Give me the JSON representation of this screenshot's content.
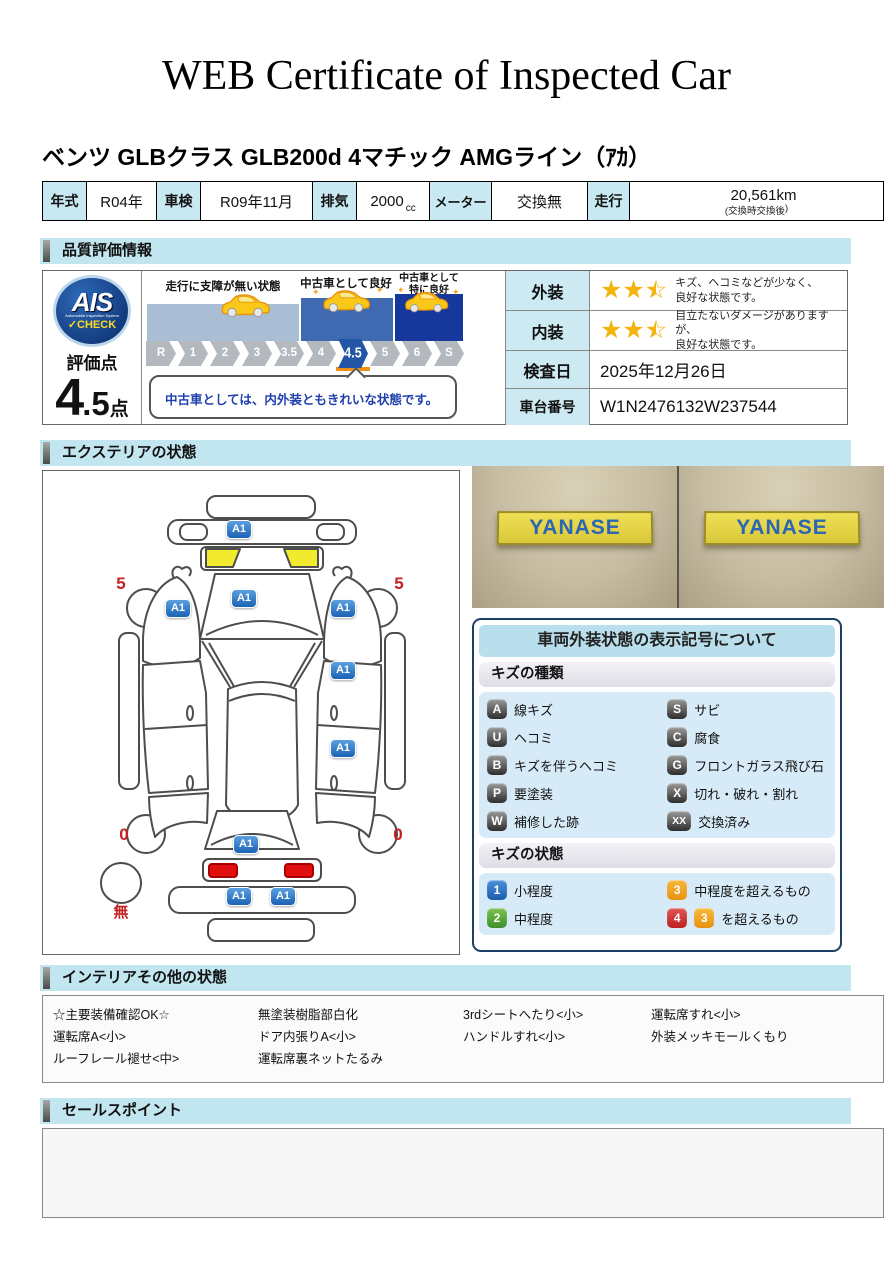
{
  "header": {
    "title": "WEB Certificate of Inspected Car",
    "vehicle": "ベンツ GLBクラス GLB200d 4マチック AMGライン（ｱｶ）"
  },
  "spec": {
    "year_label": "年式",
    "year": "R04年",
    "shaken_label": "車検",
    "shaken": "R09年11月",
    "haiki_label": "排気",
    "haiki": "2000",
    "haiki_unit": "cc",
    "meter_label": "メーター",
    "meter": "交換無",
    "soko_label": "走行",
    "mileage": "20,561km",
    "note_left": "(交換時",
    "note_mid": "交換後",
    "note_right": ")"
  },
  "sections": {
    "quality": "品質評価情報",
    "exterior": "エクステリアの状態",
    "interior": "インテリアその他の状態",
    "sales": "セールスポイント"
  },
  "quality": {
    "ais_main": "AIS",
    "ais_sub": "Automobile Inspection System",
    "ais_check": "✓CHECK",
    "score_label": "評価点",
    "score_int": "4",
    "score_dec": ".5",
    "score_unit": "点",
    "zone1": "走行に支障が無い状態",
    "zone2": "中古車として良好",
    "zone3": "中古車として\n特に良好",
    "ticks": [
      "R",
      "1",
      "2",
      "3",
      "3.5",
      "4",
      "4.5",
      "5",
      "6",
      "S"
    ],
    "active_tick": "4.5",
    "comment": "中古車としては、内外装ともきれいな状態です。",
    "exterior_label": "外装",
    "exterior_stars": 2.5,
    "exterior_text": "キズ、ヘコミなどが少なく、\n良好な状態です。",
    "interior_label": "内装",
    "interior_stars": 2.5,
    "interior_text": "目立たないダメージがありますが、\n良好な状態です。",
    "date_label": "検査日",
    "date": "2025年12月26日",
    "vin_label": "車台番号",
    "vin": "W1N2476132W237544"
  },
  "ext": {
    "marker": "A1",
    "wheel_front": "5",
    "wheel_rear": "0",
    "spare": "無",
    "photo_brand": "YANASE"
  },
  "legend": {
    "title": "車両外装状態の表示記号について",
    "kind_header": "キズの種類",
    "kinds": [
      {
        "code": "A",
        "label": "線キズ"
      },
      {
        "code": "S",
        "label": "サビ"
      },
      {
        "code": "U",
        "label": "ヘコミ"
      },
      {
        "code": "C",
        "label": "腐食"
      },
      {
        "code": "B",
        "label": "キズを伴うヘコミ"
      },
      {
        "code": "G",
        "label": "フロントガラス飛び石"
      },
      {
        "code": "P",
        "label": "要塗装"
      },
      {
        "code": "X",
        "label": "切れ・破れ・割れ"
      },
      {
        "code": "W",
        "label": "補修した跡"
      },
      {
        "code": "XX",
        "label": "交換済み"
      }
    ],
    "state_header": "キズの状態",
    "states": [
      {
        "code": "1",
        "color": "blue",
        "label": "小程度"
      },
      {
        "code": "3",
        "color": "orange",
        "label": "中程度を超えるもの"
      },
      {
        "code": "2",
        "color": "green",
        "label": "中程度"
      },
      {
        "code": "4",
        "color": "red",
        "code2": "3",
        "color2": "orange",
        "label": "を超えるもの"
      }
    ]
  },
  "interior_box": {
    "col1": [
      "☆主要装備確認OK☆",
      "運転席A<小>",
      "ルーフレール褪せ<中>"
    ],
    "col2": [
      "無塗装樹脂部白化",
      "ドア内張りA<小>",
      "運転席裏ネットたるみ"
    ],
    "col3": [
      "3rdシートへたり<小>",
      "ハンドルすれ<小>"
    ],
    "col4": [
      "運転席すれ<小>",
      "外装メッキモールくもり"
    ]
  },
  "icons": {
    "star_full": "★",
    "star_empty": "☆",
    "sparkle": "✦"
  },
  "colors": {
    "section_header_bg": "#c2e6ef",
    "label_cell_bg": "#c8e9f2",
    "marker_blue": "#1b62b4",
    "star_yellow": "#f2b50f",
    "highlight_yellow": "#f2ea2d",
    "alert_red": "#cc2222",
    "active_tick_blue": "#2456a8"
  }
}
